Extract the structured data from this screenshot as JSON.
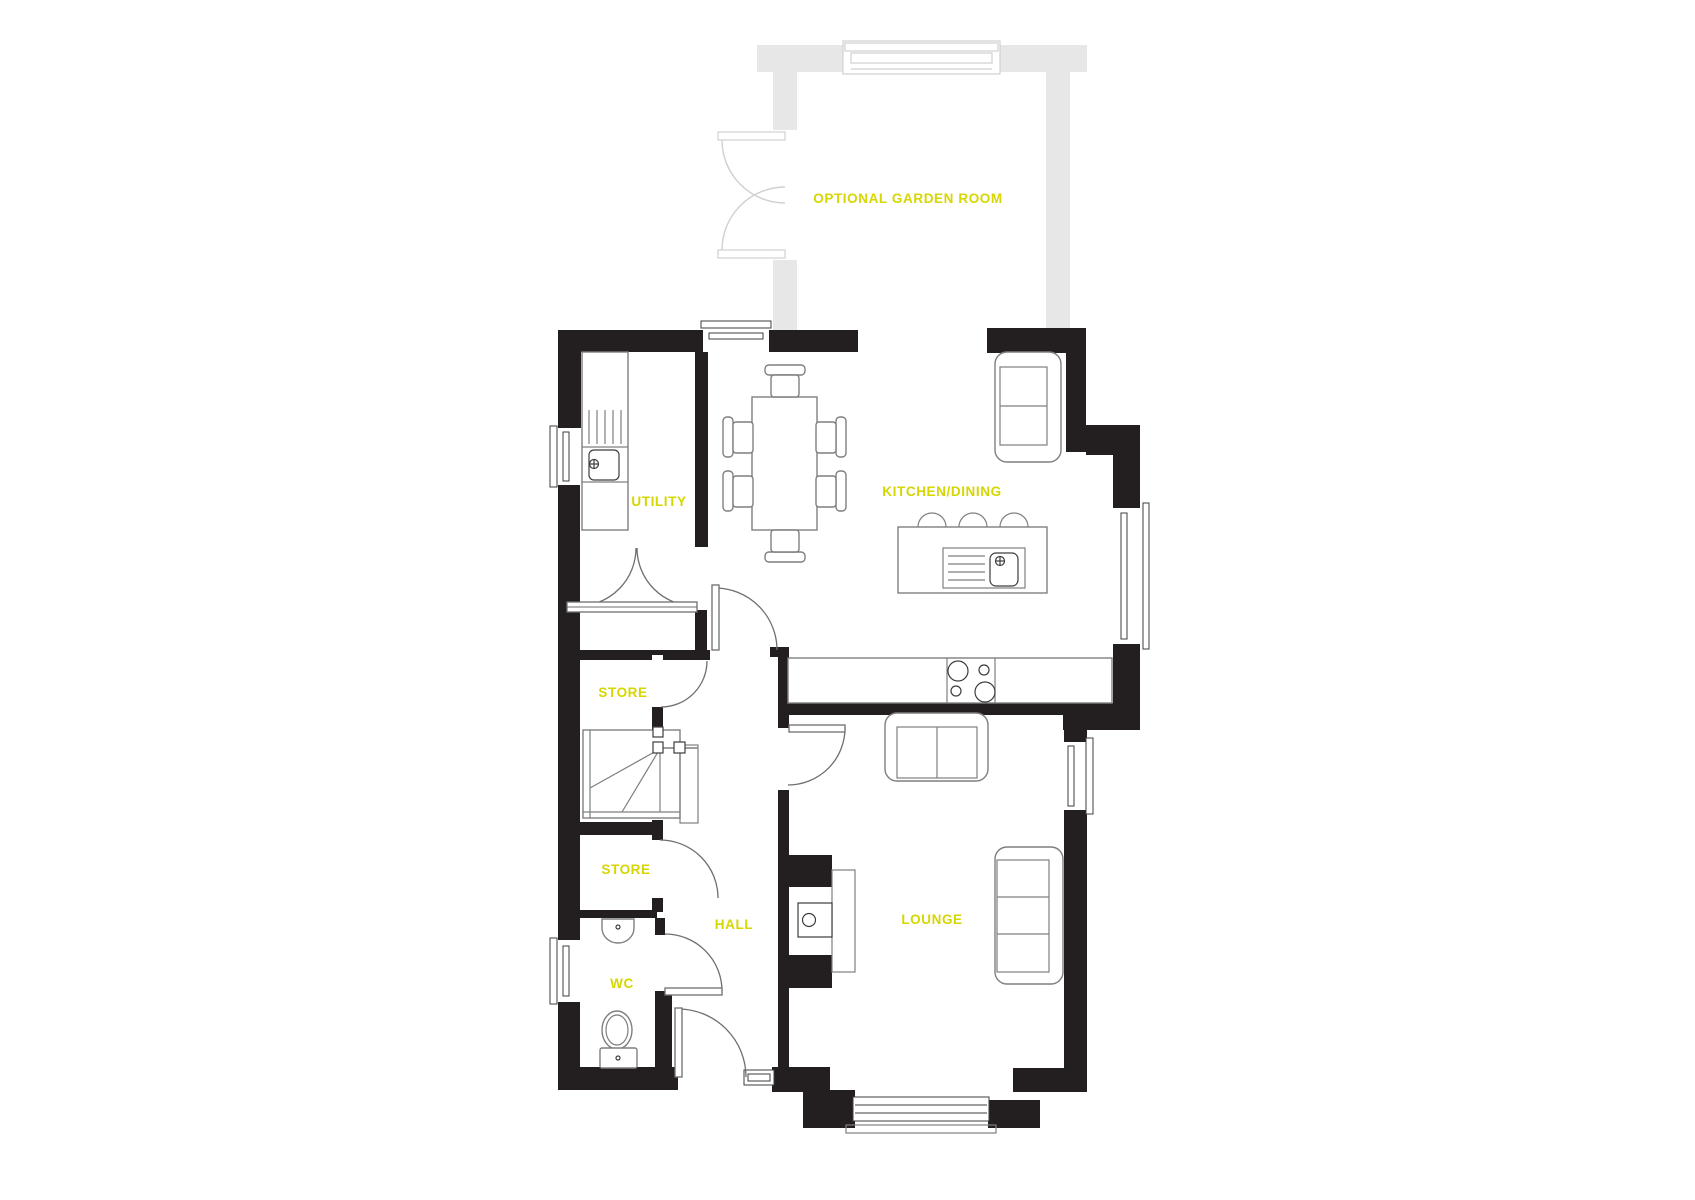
{
  "colors": {
    "accent": "#d6d600",
    "wall": "#231f20",
    "optional-wall": "#e8e7e7",
    "garden-line": "#d0d0d0",
    "fixture-line": "#7f7f7f",
    "door-line": "#6e6e6e",
    "window-line": "#3d3d3d"
  },
  "rooms": {
    "garden_room": {
      "label": "OPTIONAL GARDEN ROOM"
    },
    "utility": {
      "label": "UTILITY"
    },
    "kitchen_dining": {
      "label": "KITCHEN/DINING"
    },
    "store_upper": {
      "label": "STORE"
    },
    "store_lower": {
      "label": "STORE"
    },
    "hall": {
      "label": "HALL"
    },
    "wc": {
      "label": "WC"
    },
    "lounge": {
      "label": "LOUNGE"
    }
  }
}
